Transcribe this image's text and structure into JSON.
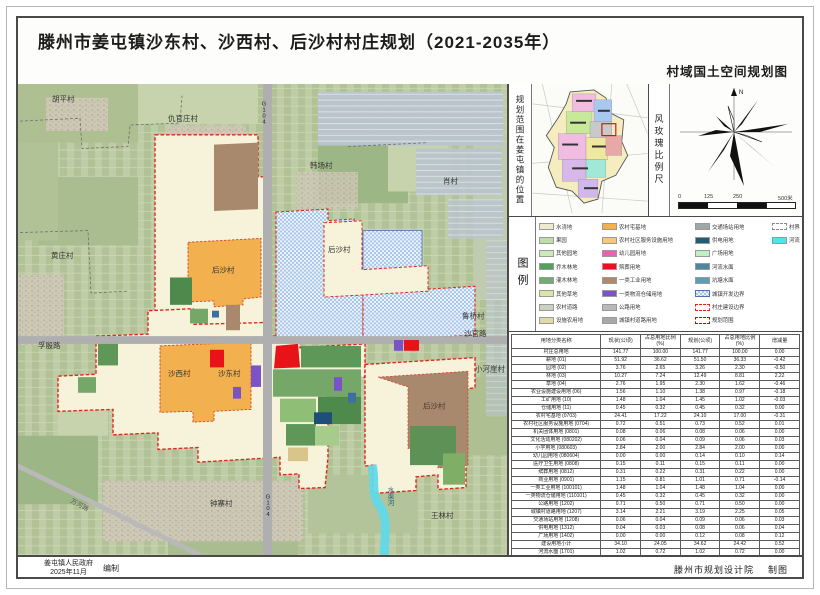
{
  "header": {
    "title": "滕州市姜屯镇沙东村、沙西村、后沙村村庄规划（2021-2035年）",
    "subtitle": "村域国土空间规划图"
  },
  "sidebar": {
    "location_label": "规划范围在姜屯镇的位置",
    "windrose_label": "风玫瑰比例尺",
    "north_label": "N",
    "scale_ticks": [
      "0",
      "125",
      "250",
      "500米"
    ],
    "legend_title": "图例",
    "legend_columns": [
      [
        {
          "label": "水浇地",
          "color": "#efeacd",
          "style": "solid"
        },
        {
          "label": "果园",
          "color": "#bbdfa6",
          "style": "solid"
        },
        {
          "label": "其他园地",
          "color": "#cde8bd",
          "style": "solid"
        },
        {
          "label": "乔木林地",
          "color": "#55a05c",
          "style": "solid"
        },
        {
          "label": "灌木林地",
          "color": "#6fae6f",
          "style": "solid"
        },
        {
          "label": "其他草地",
          "color": "#d8e8a4",
          "style": "solid"
        },
        {
          "label": "农村道路",
          "color": "#cad1be",
          "style": "solid"
        },
        {
          "label": "设施农用地",
          "color": "#dfdaa6",
          "style": "solid"
        }
      ],
      [
        {
          "label": "农村宅基地",
          "color": "#f2b04e",
          "style": "solid"
        },
        {
          "label": "农村社区服务设施用地",
          "color": "#f6c978",
          "style": "solid"
        },
        {
          "label": "幼儿园用地",
          "color": "#ee5fb2",
          "style": "solid"
        },
        {
          "label": "殡葬用地",
          "color": "#e8121a",
          "style": "solid"
        },
        {
          "label": "一类工业用地",
          "color": "#b08968",
          "style": "solid"
        },
        {
          "label": "一类物流仓储用地",
          "color": "#7b52c8",
          "style": "solid"
        },
        {
          "label": "公路用地",
          "color": "#b9b9b9",
          "style": "solid"
        },
        {
          "label": "城镇村道路用地",
          "color": "#a8a8a8",
          "style": "solid"
        }
      ],
      [
        {
          "label": "交通场站用地",
          "color": "#9fa8a4",
          "style": "solid"
        },
        {
          "label": "供电用地",
          "color": "#1e5f73",
          "style": "solid"
        },
        {
          "label": "广场用地",
          "color": "#bfefc3",
          "style": "solid"
        },
        {
          "label": "河流水面",
          "color": "#4e87a0",
          "style": "solid"
        },
        {
          "label": "坑塘水面",
          "color": "#58a0b4",
          "style": "solid"
        },
        {
          "label": "城镇开发边界",
          "color": "",
          "style": "checker"
        },
        {
          "label": "村庄建设边界",
          "color": "",
          "style": "dashRed"
        },
        {
          "label": "规划范围",
          "color": "",
          "style": "dashRedBold"
        }
      ],
      [
        {
          "label": "村界",
          "color": "",
          "style": "dashGray"
        },
        {
          "label": "河流",
          "color": "#4fe3ee",
          "style": "solid"
        }
      ]
    ]
  },
  "table": {
    "header": [
      "用地分类名称",
      "现状(公顷)",
      "占总用地比例(%)",
      "规划(公顷)",
      "占总用地比例(%)",
      "增减量"
    ],
    "rows": [
      [
        "村庄总用地",
        "141.77",
        "100.00",
        "141.77",
        "100.00",
        "0.00"
      ],
      [
        "耕地 (01)",
        "51.92",
        "36.62",
        "51.50",
        "36.33",
        "-0.42"
      ],
      [
        "园地 (02)",
        "3.76",
        "2.65",
        "3.26",
        "2.30",
        "-0.50"
      ],
      [
        "林地 (03)",
        "10.27",
        "7.24",
        "12.49",
        "8.81",
        "2.22"
      ],
      [
        "草地 (04)",
        "2.76",
        "1.95",
        "2.30",
        "1.62",
        "-0.46"
      ],
      [
        "农业设施建设用地 (06)",
        "1.56",
        "1.10",
        "1.38",
        "0.97",
        "-0.18"
      ],
      [
        "工矿用地 (10)",
        "1.48",
        "1.04",
        "1.45",
        "1.02",
        "-0.03"
      ],
      [
        "仓储用地 (11)",
        "0.45",
        "0.32",
        "0.45",
        "0.32",
        "0.00"
      ],
      [
        "农村宅基地 (0703)",
        "24.41",
        "17.22",
        "24.10",
        "17.00",
        "-0.31"
      ],
      [
        "农村社区服务设施用地 (0704)",
        "0.72",
        "0.51",
        "0.73",
        "0.52",
        "0.01"
      ],
      [
        "机关团体用地 (0801)",
        "0.08",
        "0.06",
        "0.08",
        "0.06",
        "0.00"
      ],
      [
        "文化活动用地 (080202)",
        "0.06",
        "0.04",
        "0.09",
        "0.06",
        "0.03"
      ],
      [
        "小学用地 (080603)",
        "2.84",
        "2.00",
        "2.84",
        "2.00",
        "0.00"
      ],
      [
        "幼儿园用地 (080604)",
        "0.00",
        "0.00",
        "0.14",
        "0.10",
        "0.14"
      ],
      [
        "医疗卫生用地 (0808)",
        "0.15",
        "0.11",
        "0.15",
        "0.11",
        "0.00"
      ],
      [
        "殡葬用地 (0812)",
        "0.31",
        "0.22",
        "0.31",
        "0.22",
        "0.00"
      ],
      [
        "商业用地 (0901)",
        "1.15",
        "0.81",
        "1.01",
        "0.71",
        "-0.14"
      ],
      [
        "一类工业用地 (100101)",
        "1.48",
        "1.04",
        "1.48",
        "1.04",
        "0.00"
      ],
      [
        "一类物流仓储用地 (110101)",
        "0.45",
        "0.32",
        "0.45",
        "0.32",
        "0.00"
      ],
      [
        "公路用地 (1202)",
        "0.71",
        "0.50",
        "0.71",
        "0.50",
        "0.00"
      ],
      [
        "城镇村道路用地 (1207)",
        "3.14",
        "2.21",
        "3.19",
        "2.25",
        "0.05"
      ],
      [
        "交通场站用地 (1208)",
        "0.06",
        "0.04",
        "0.09",
        "0.06",
        "0.03"
      ],
      [
        "供电用地 (1312)",
        "0.04",
        "0.03",
        "0.08",
        "0.06",
        "0.04"
      ],
      [
        "广场用地 (1402)",
        "0.00",
        "0.00",
        "0.12",
        "0.08",
        "0.12"
      ],
      [
        "建设用地小计",
        "34.10",
        "24.05",
        "34.62",
        "24.42",
        "0.52"
      ],
      [
        "河流水面 (1701)",
        "1.02",
        "0.72",
        "1.02",
        "0.72",
        "0.00"
      ],
      [
        "坑塘水面 (1704)",
        "2.10",
        "1.48",
        "1.95",
        "1.38",
        "-0.15"
      ],
      [
        "沟渠 (1706)",
        "0.28",
        "0.20",
        "0.28",
        "0.20",
        "0.00"
      ],
      [
        "其他土地 (23)",
        "0.90",
        "0.63",
        "0.32",
        "0.23",
        "-0.58"
      ]
    ]
  },
  "map": {
    "labels": [
      {
        "text": "胡平村"
      },
      {
        "text": "仇官庄村"
      },
      {
        "text": "韩场村"
      },
      {
        "text": "肖村"
      },
      {
        "text": "黄庄村"
      },
      {
        "text": "孚殷路"
      },
      {
        "text": "后沙村"
      },
      {
        "text": "后沙村"
      },
      {
        "text": "沙西村"
      },
      {
        "text": "沙东村"
      },
      {
        "text": "后沙村"
      },
      {
        "text": "小河崖村"
      },
      {
        "text": "鲁桥村"
      },
      {
        "text": "沙官路"
      },
      {
        "text": "钟寨村"
      },
      {
        "text": "王林村"
      },
      {
        "text": "G104"
      },
      {
        "text": "G104"
      },
      {
        "text": "水渠河"
      },
      {
        "text": "万河路"
      }
    ]
  },
  "footer": {
    "left_org": "姜屯镇人民政府",
    "left_date": "2025年11月",
    "left_role": "编制",
    "right_org": "滕州市规划设计院",
    "right_role": "制图"
  }
}
